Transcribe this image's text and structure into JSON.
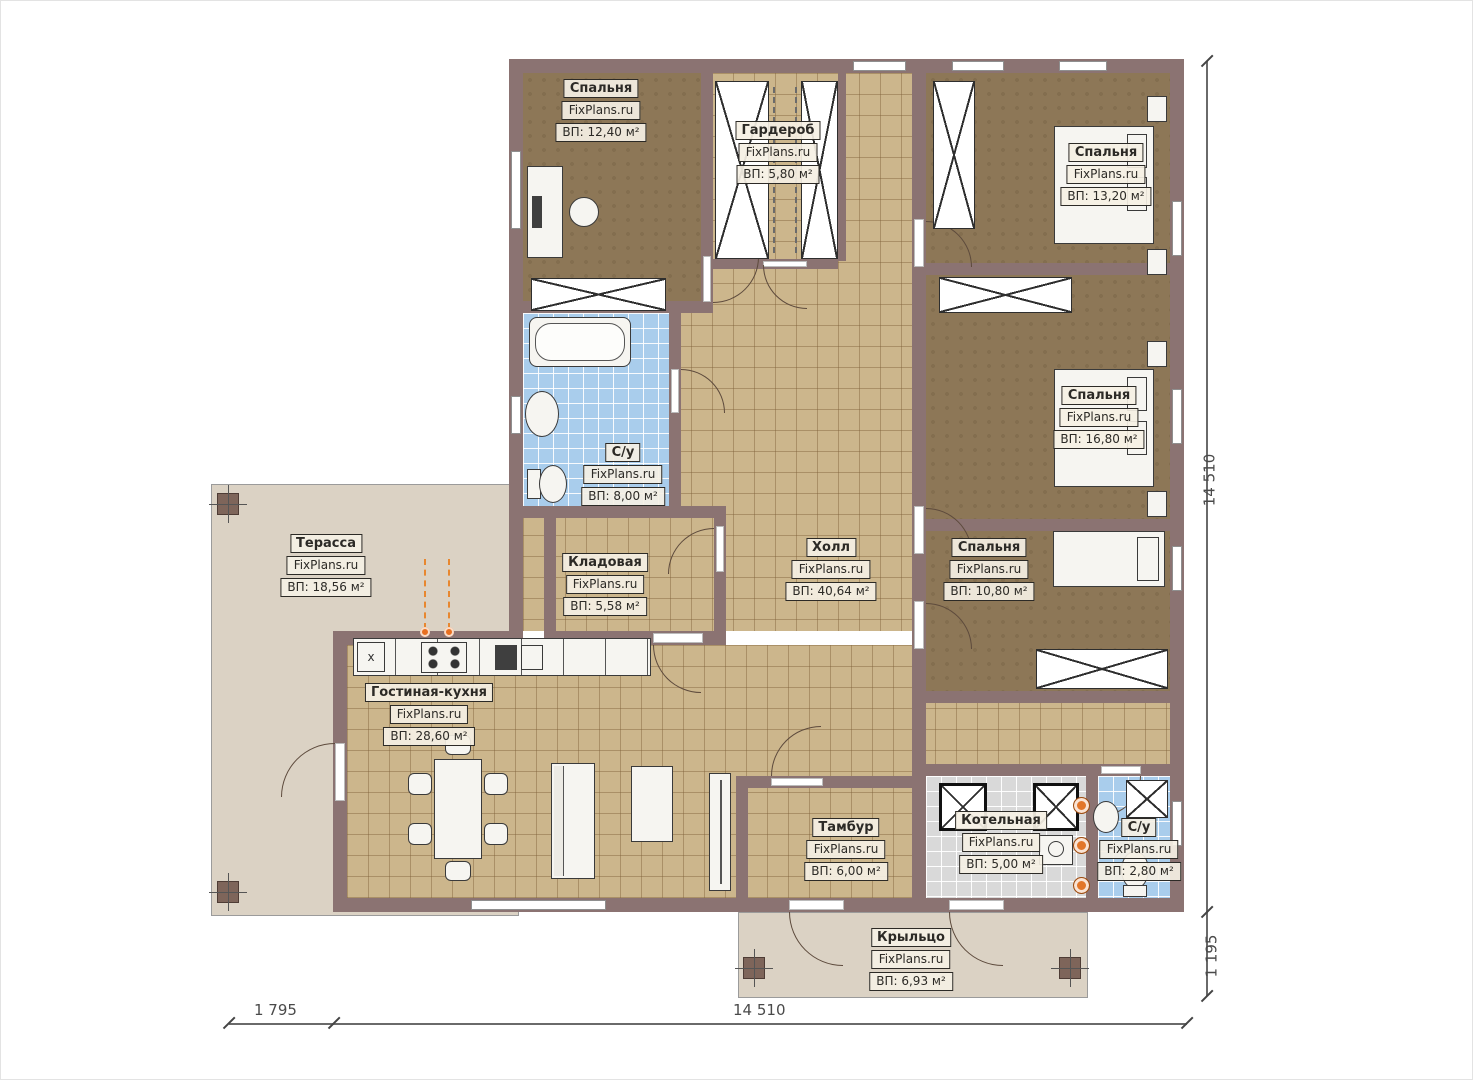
{
  "plan_title": "FixPlans.ru floor plan",
  "rooms": {
    "bedroom1": {
      "name": "Спальня",
      "brand": "FixPlans.ru",
      "area": "ВП: 12,40 м²"
    },
    "wardrobe": {
      "name": "Гардероб",
      "brand": "FixPlans.ru",
      "area": "ВП: 5,80 м²"
    },
    "bedroom2": {
      "name": "Спальня",
      "brand": "FixPlans.ru",
      "area": "ВП: 13,20 м²"
    },
    "bedroom3": {
      "name": "Спальня",
      "brand": "FixPlans.ru",
      "area": "ВП: 16,80 м²"
    },
    "bedroom4": {
      "name": "Спальня",
      "brand": "FixPlans.ru",
      "area": "ВП: 10,80 м²"
    },
    "bath1": {
      "name": "С/у",
      "brand": "FixPlans.ru",
      "area": "ВП: 8,00 м²"
    },
    "pantry": {
      "name": "Кладовая",
      "brand": "FixPlans.ru",
      "area": "ВП: 5,58 м²"
    },
    "hall": {
      "name": "Холл",
      "brand": "FixPlans.ru",
      "area": "ВП: 40,64 м²"
    },
    "terrace": {
      "name": "Терасса",
      "brand": "FixPlans.ru",
      "area": "ВП: 18,56 м²"
    },
    "living": {
      "name": "Гостиная-кухня",
      "brand": "FixPlans.ru",
      "area": "ВП: 28,60 м²"
    },
    "vestibule": {
      "name": "Тамбур",
      "brand": "FixPlans.ru",
      "area": "ВП: 6,00 м²"
    },
    "boiler": {
      "name": "Котельная",
      "brand": "FixPlans.ru",
      "area": "ВП: 5,00 м²"
    },
    "bath2": {
      "name": "С/у",
      "brand": "FixPlans.ru",
      "area": "ВП: 2,80 м²"
    },
    "porch": {
      "name": "Крыльцо",
      "brand": "FixPlans.ru",
      "area": "ВП: 6,93 м²"
    }
  },
  "dimensions": {
    "right_main": "14 510",
    "right_porch": "1 195",
    "bottom_left": "1 795",
    "bottom_main": "14 510"
  },
  "kitchen": {
    "marker": "x"
  },
  "colors": {
    "wall": "#8b7372",
    "bedroom_floor": "#8d7757",
    "tile_floor": "#ccb68c",
    "bath_floor": "#a9cdec",
    "boiler_floor": "#d9d9d9",
    "terrace_floor": "#dbd2c4",
    "accent_orange": "#e2762a"
  }
}
